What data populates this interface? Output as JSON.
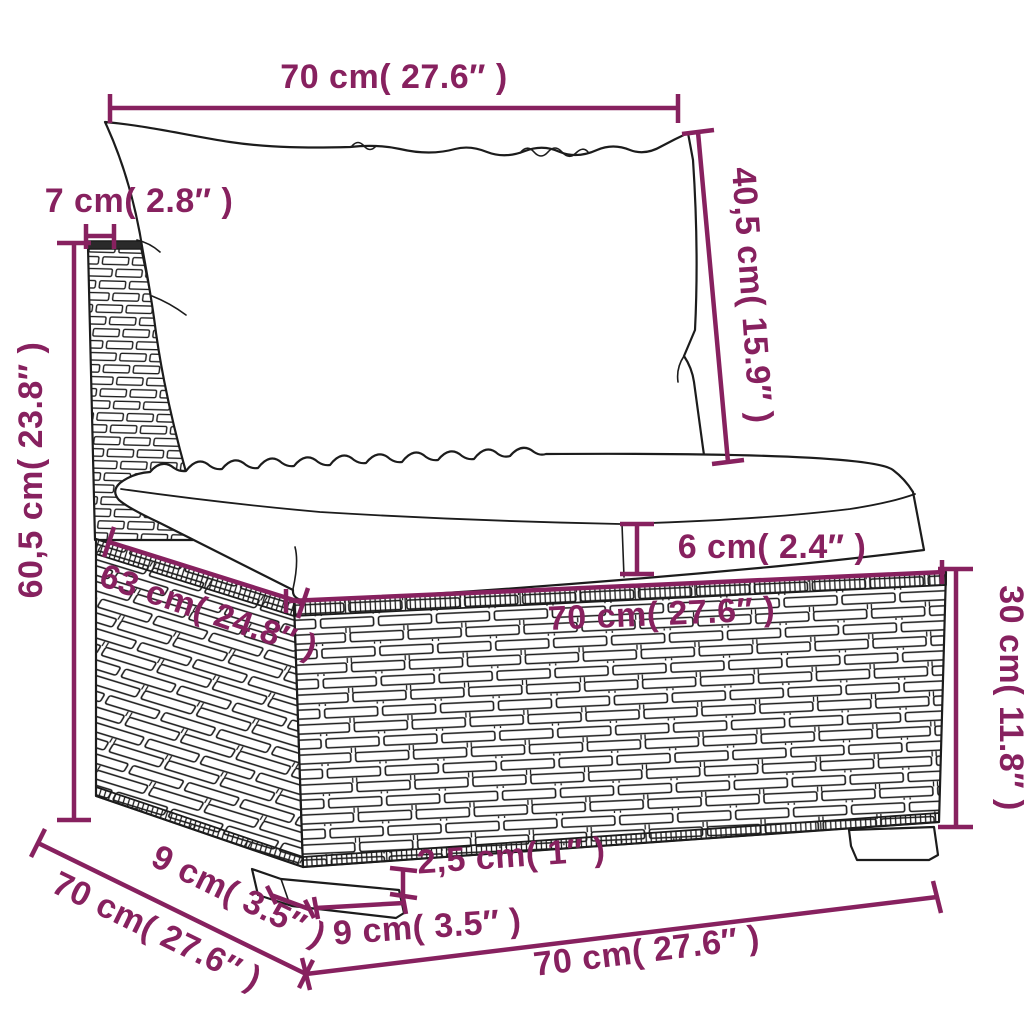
{
  "page": {
    "background": "#ffffff"
  },
  "diagram": {
    "kind": "furniture-dimension-diagram",
    "subject": "poly-rattan sofa middle section with back cushion and seat cushion",
    "accent_color": "#87215F",
    "outline_color": "#1c1c1c",
    "dimensions": {
      "back_cushion_width": "70 cm( 27.6″ )",
      "back_post_width": "7 cm( 2.8″ )",
      "back_cushion_height": "40,5 cm( 15.9″ )",
      "overall_height": "60,5 cm( 23.8″ )",
      "seat_cushion_thickness": "6 cm( 2.4″ )",
      "seat_width": "70 cm( 27.6″ )",
      "seat_depth": "63 cm( 24.8″ )",
      "base_height": "30 cm( 11.8″ )",
      "foot_height": "2,5 cm( 1″ )",
      "foot_width_front": "9 cm( 3.5″ )",
      "foot_depth_side": "9 cm( 3.5″ )",
      "depth_overall": "70 cm( 27.6″ )",
      "width_overall": "70 cm( 27.6″ )"
    }
  }
}
